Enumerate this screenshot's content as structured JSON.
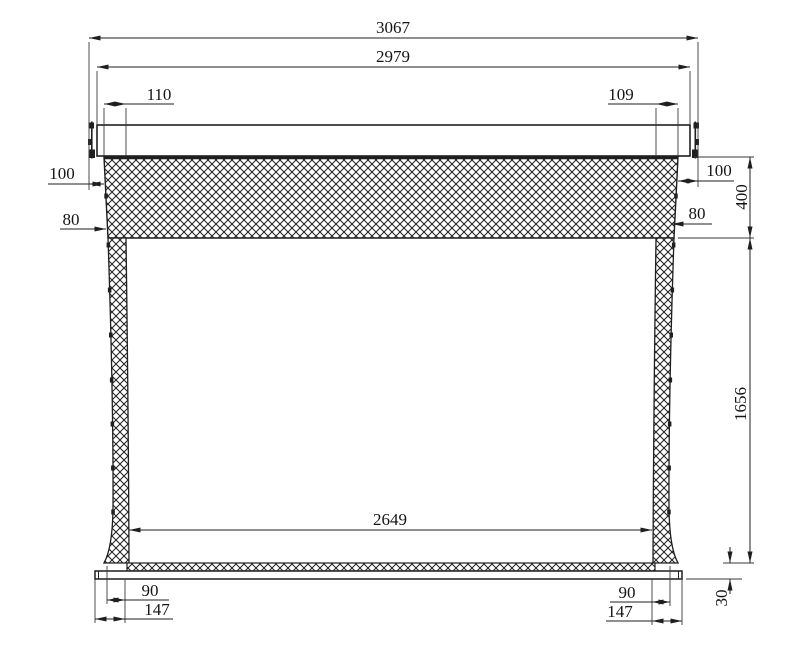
{
  "colors": {
    "background": "#ffffff",
    "line": "#1f1f1f",
    "hatch": "#1f1f1f"
  },
  "dimensions": {
    "overall_width": {
      "value": "3067"
    },
    "case_width": {
      "value": "2979"
    },
    "offset_top_left": {
      "value": "110"
    },
    "offset_top_right": {
      "value": "109"
    },
    "edge_left": {
      "value": "100"
    },
    "edge_right": {
      "value": "100"
    },
    "border_left": {
      "value": "80"
    },
    "border_right": {
      "value": "80"
    },
    "top_band_height": {
      "value": "400"
    },
    "screen_height": {
      "value": "1656"
    },
    "viewing_width": {
      "value": "2649"
    },
    "foot_left_inner": {
      "value": "90"
    },
    "foot_left_outer": {
      "value": "147"
    },
    "foot_right_inner": {
      "value": "90"
    },
    "foot_right_outer": {
      "value": "147"
    },
    "bottom_bar_height": {
      "value": "30"
    }
  }
}
